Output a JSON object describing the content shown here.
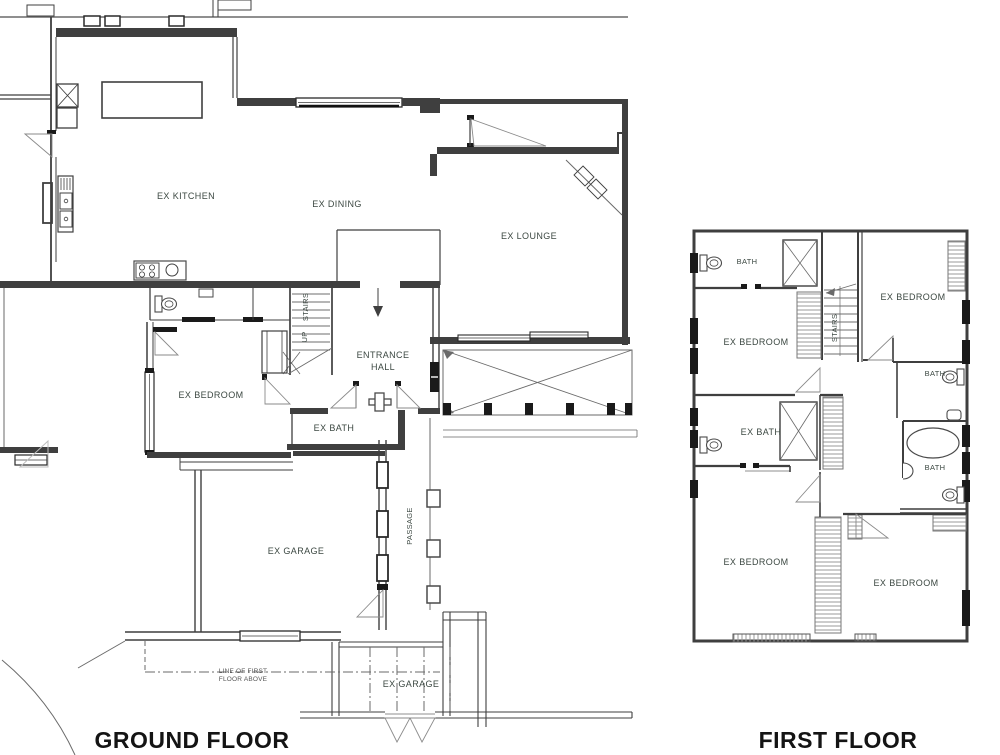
{
  "document": {
    "type": "architectural-floor-plan",
    "background": "#ffffff",
    "colors": {
      "wall": "#3f3f3f",
      "label": "#3c4842",
      "title": "#141414",
      "hatch": "#9a9a9a",
      "glass_dark": "#1a1a1a",
      "swing_gray": "#8a8a8a"
    }
  },
  "ground_floor": {
    "title": "GROUND FLOOR",
    "labels": {
      "kitchen": "EX KITCHEN",
      "dining": "EX DINING",
      "lounge": "EX LOUNGE",
      "entrance_hall_line1": "ENTRANCE",
      "entrance_hall_line2": "HALL",
      "stairs": "STAIRS",
      "up": "UP",
      "bedroom": "EX BEDROOM",
      "bath": "EX BATH",
      "garage": "EX GARAGE",
      "passage": "PASSAGE",
      "line_of_first_floor_line1": "LINE OF FIRST",
      "line_of_first_floor_line2": "FLOOR ABOVE",
      "garage_detached": "EX GARAGE"
    }
  },
  "first_floor": {
    "title": "FIRST FLOOR",
    "labels": {
      "bath_top_left": "BATH",
      "bedroom_top_right": "EX BEDROOM",
      "bedroom_mid_left": "EX BEDROOM",
      "stairs": "STAIRS",
      "bath_mid_right": "BATH",
      "ex_bath": "EX BATH",
      "bath_right": "BATH",
      "bedroom_bottom_left": "EX BEDROOM",
      "bedroom_bottom_right": "EX BEDROOM"
    }
  }
}
